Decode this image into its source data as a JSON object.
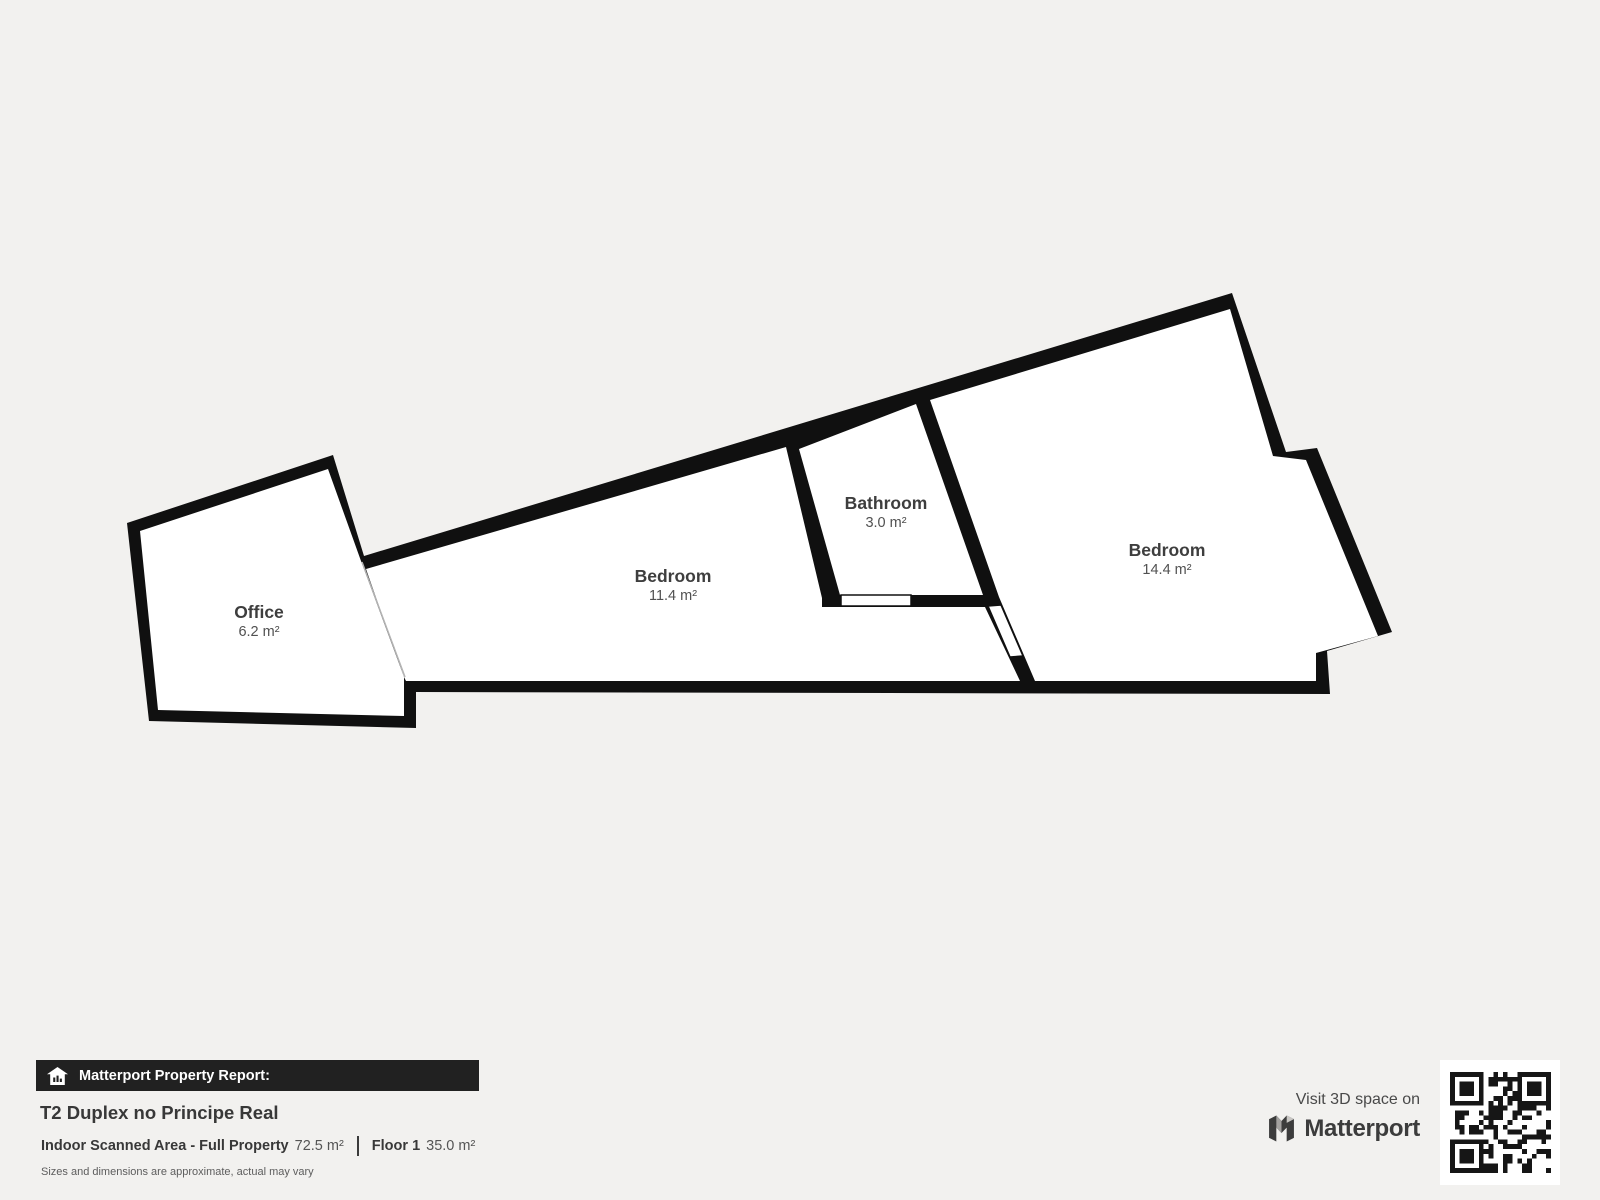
{
  "floorplan": {
    "rooms": [
      {
        "name": "Office",
        "area": "6.2 m²"
      },
      {
        "name": "Bedroom",
        "area": "11.4 m²"
      },
      {
        "name": "Bathroom",
        "area": "3.0 m²"
      },
      {
        "name": "Bedroom",
        "area": "14.4 m²"
      }
    ]
  },
  "report": {
    "badge": "Matterport Property Report:",
    "title": "T2 Duplex no Principe Real",
    "scanned_label": "Indoor Scanned Area - Full Property",
    "scanned_value": "72.5 m²",
    "floor_label": "Floor 1",
    "floor_value": "35.0 m²",
    "disclaimer": "Sizes and dimensions are approximate, actual may vary"
  },
  "promo": {
    "visit_text": "Visit 3D space on",
    "brand": "Matterport"
  },
  "colors": {
    "background": "#f2f1ef",
    "wall": "#101010",
    "room": "#ffffff"
  }
}
